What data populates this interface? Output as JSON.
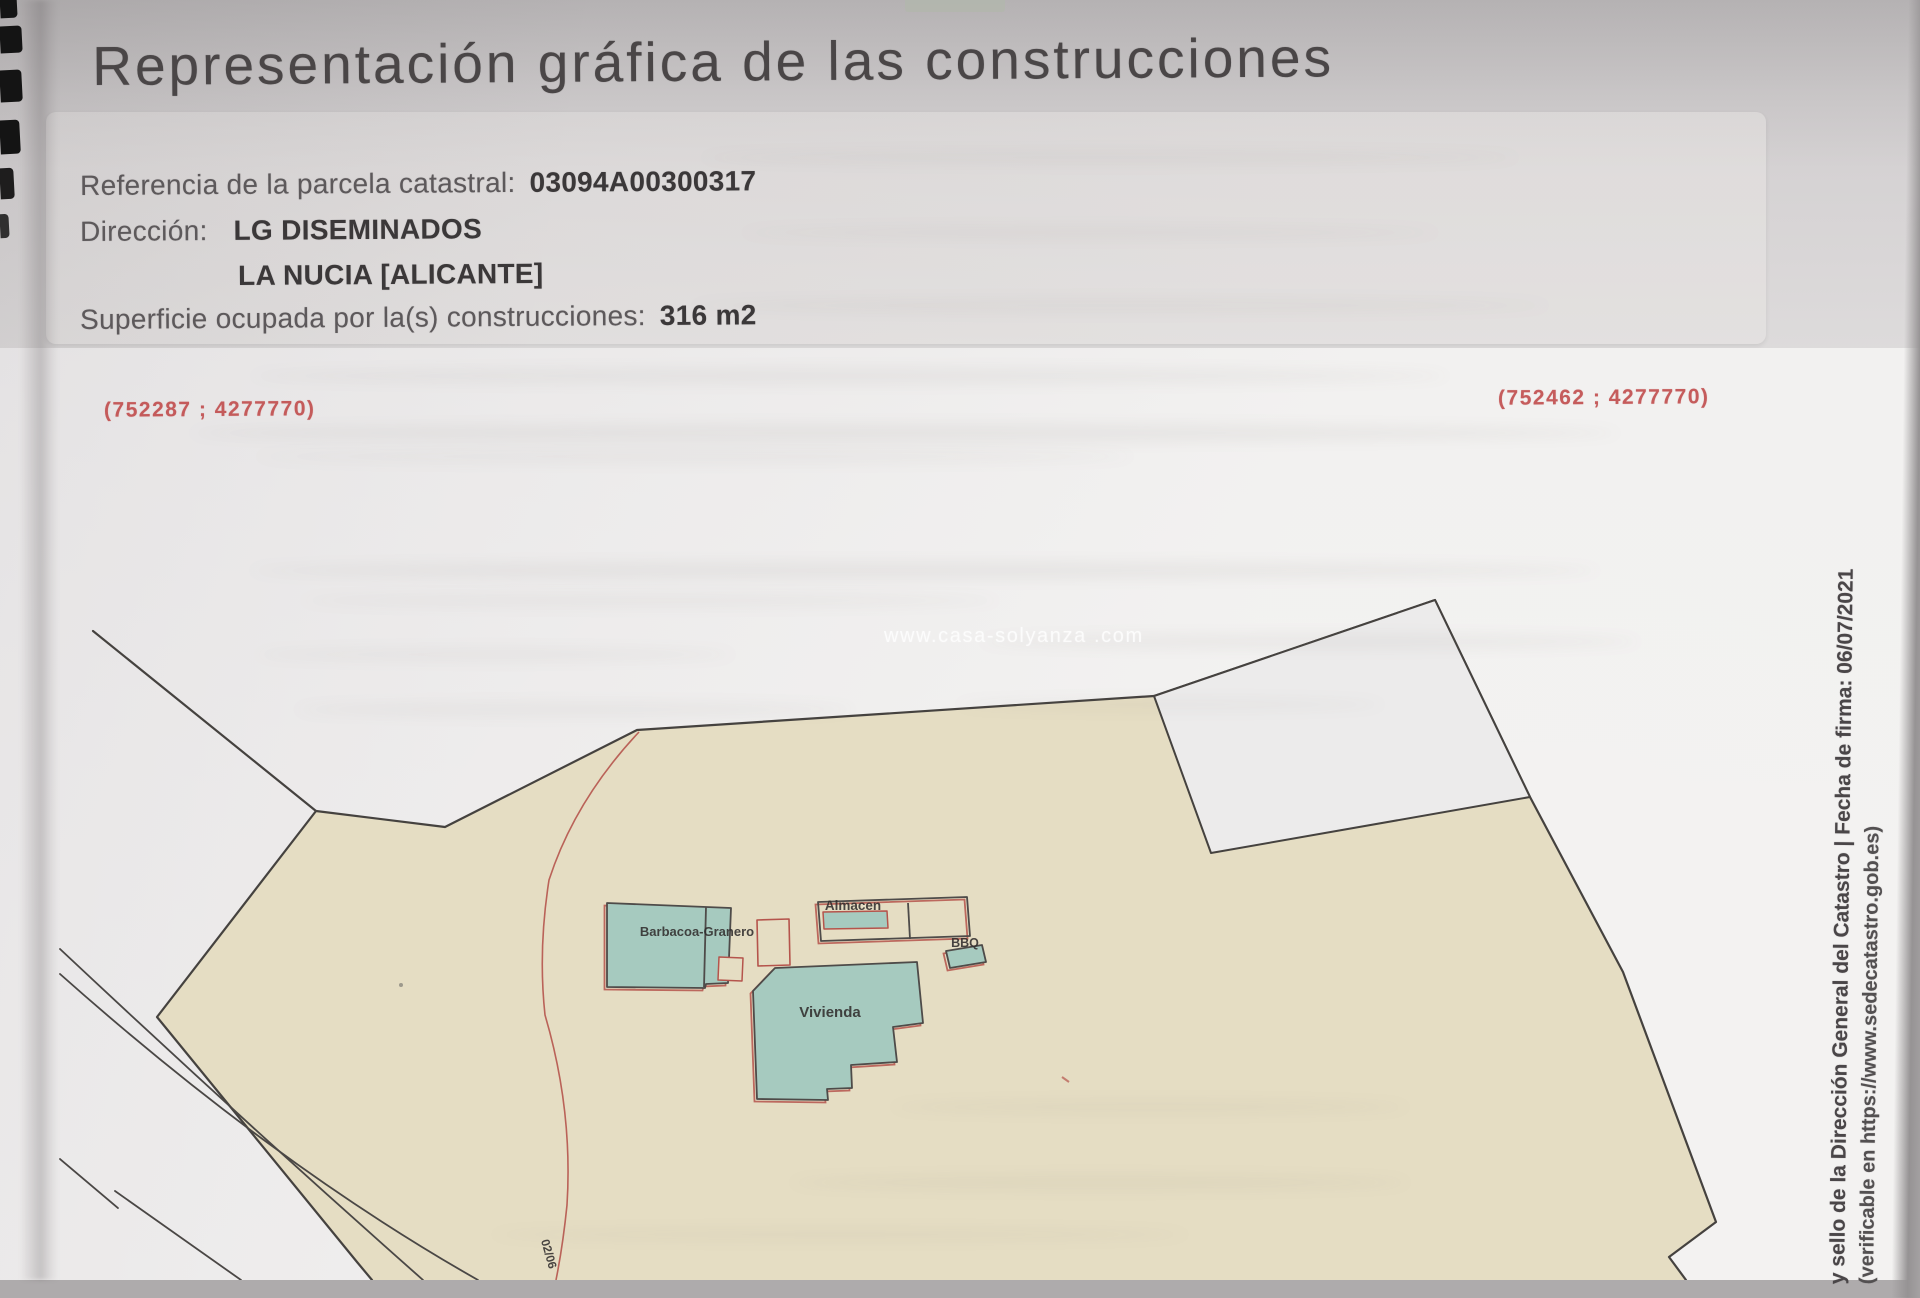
{
  "title": "Representación gráfica de las construcciones",
  "info": {
    "ref_label": "Referencia de la parcela catastral:",
    "ref_value": "03094A00300317",
    "direccion_label": "Dirección:",
    "direccion_value": "LG DISEMINADOS",
    "direccion_value2": "LA NUCIA [ALICANTE]",
    "superficie_label": "Superficie ocupada por la(s) construcciones:",
    "superficie_value": "316 m2"
  },
  "map": {
    "coord_left": "(752287 ; 4277770)",
    "coord_right": "(752462 ; 4277770)",
    "buildings": {
      "granero": "Barbacoa-Granero",
      "almacen": "Almacen",
      "bbq": "BBQ",
      "vivienda": "Vivienda"
    },
    "plot_code": "02/06"
  },
  "watermark": "www.casa-solyanza .com",
  "side_note": {
    "line1": "y sello de la Dirección General del Catastro  |  Fecha de firma: 06/07/2021",
    "line2": "(verificable en https://www.sedecatastro.gob.es)"
  },
  "colors": {
    "parcel_beige": "#e5ddc3",
    "building_teal": "#a6cabf",
    "outline_red": "#b5544c",
    "outline_dark": "#45423f",
    "coord_red": "#c14c4c",
    "paper_white": "#ecebeb"
  }
}
